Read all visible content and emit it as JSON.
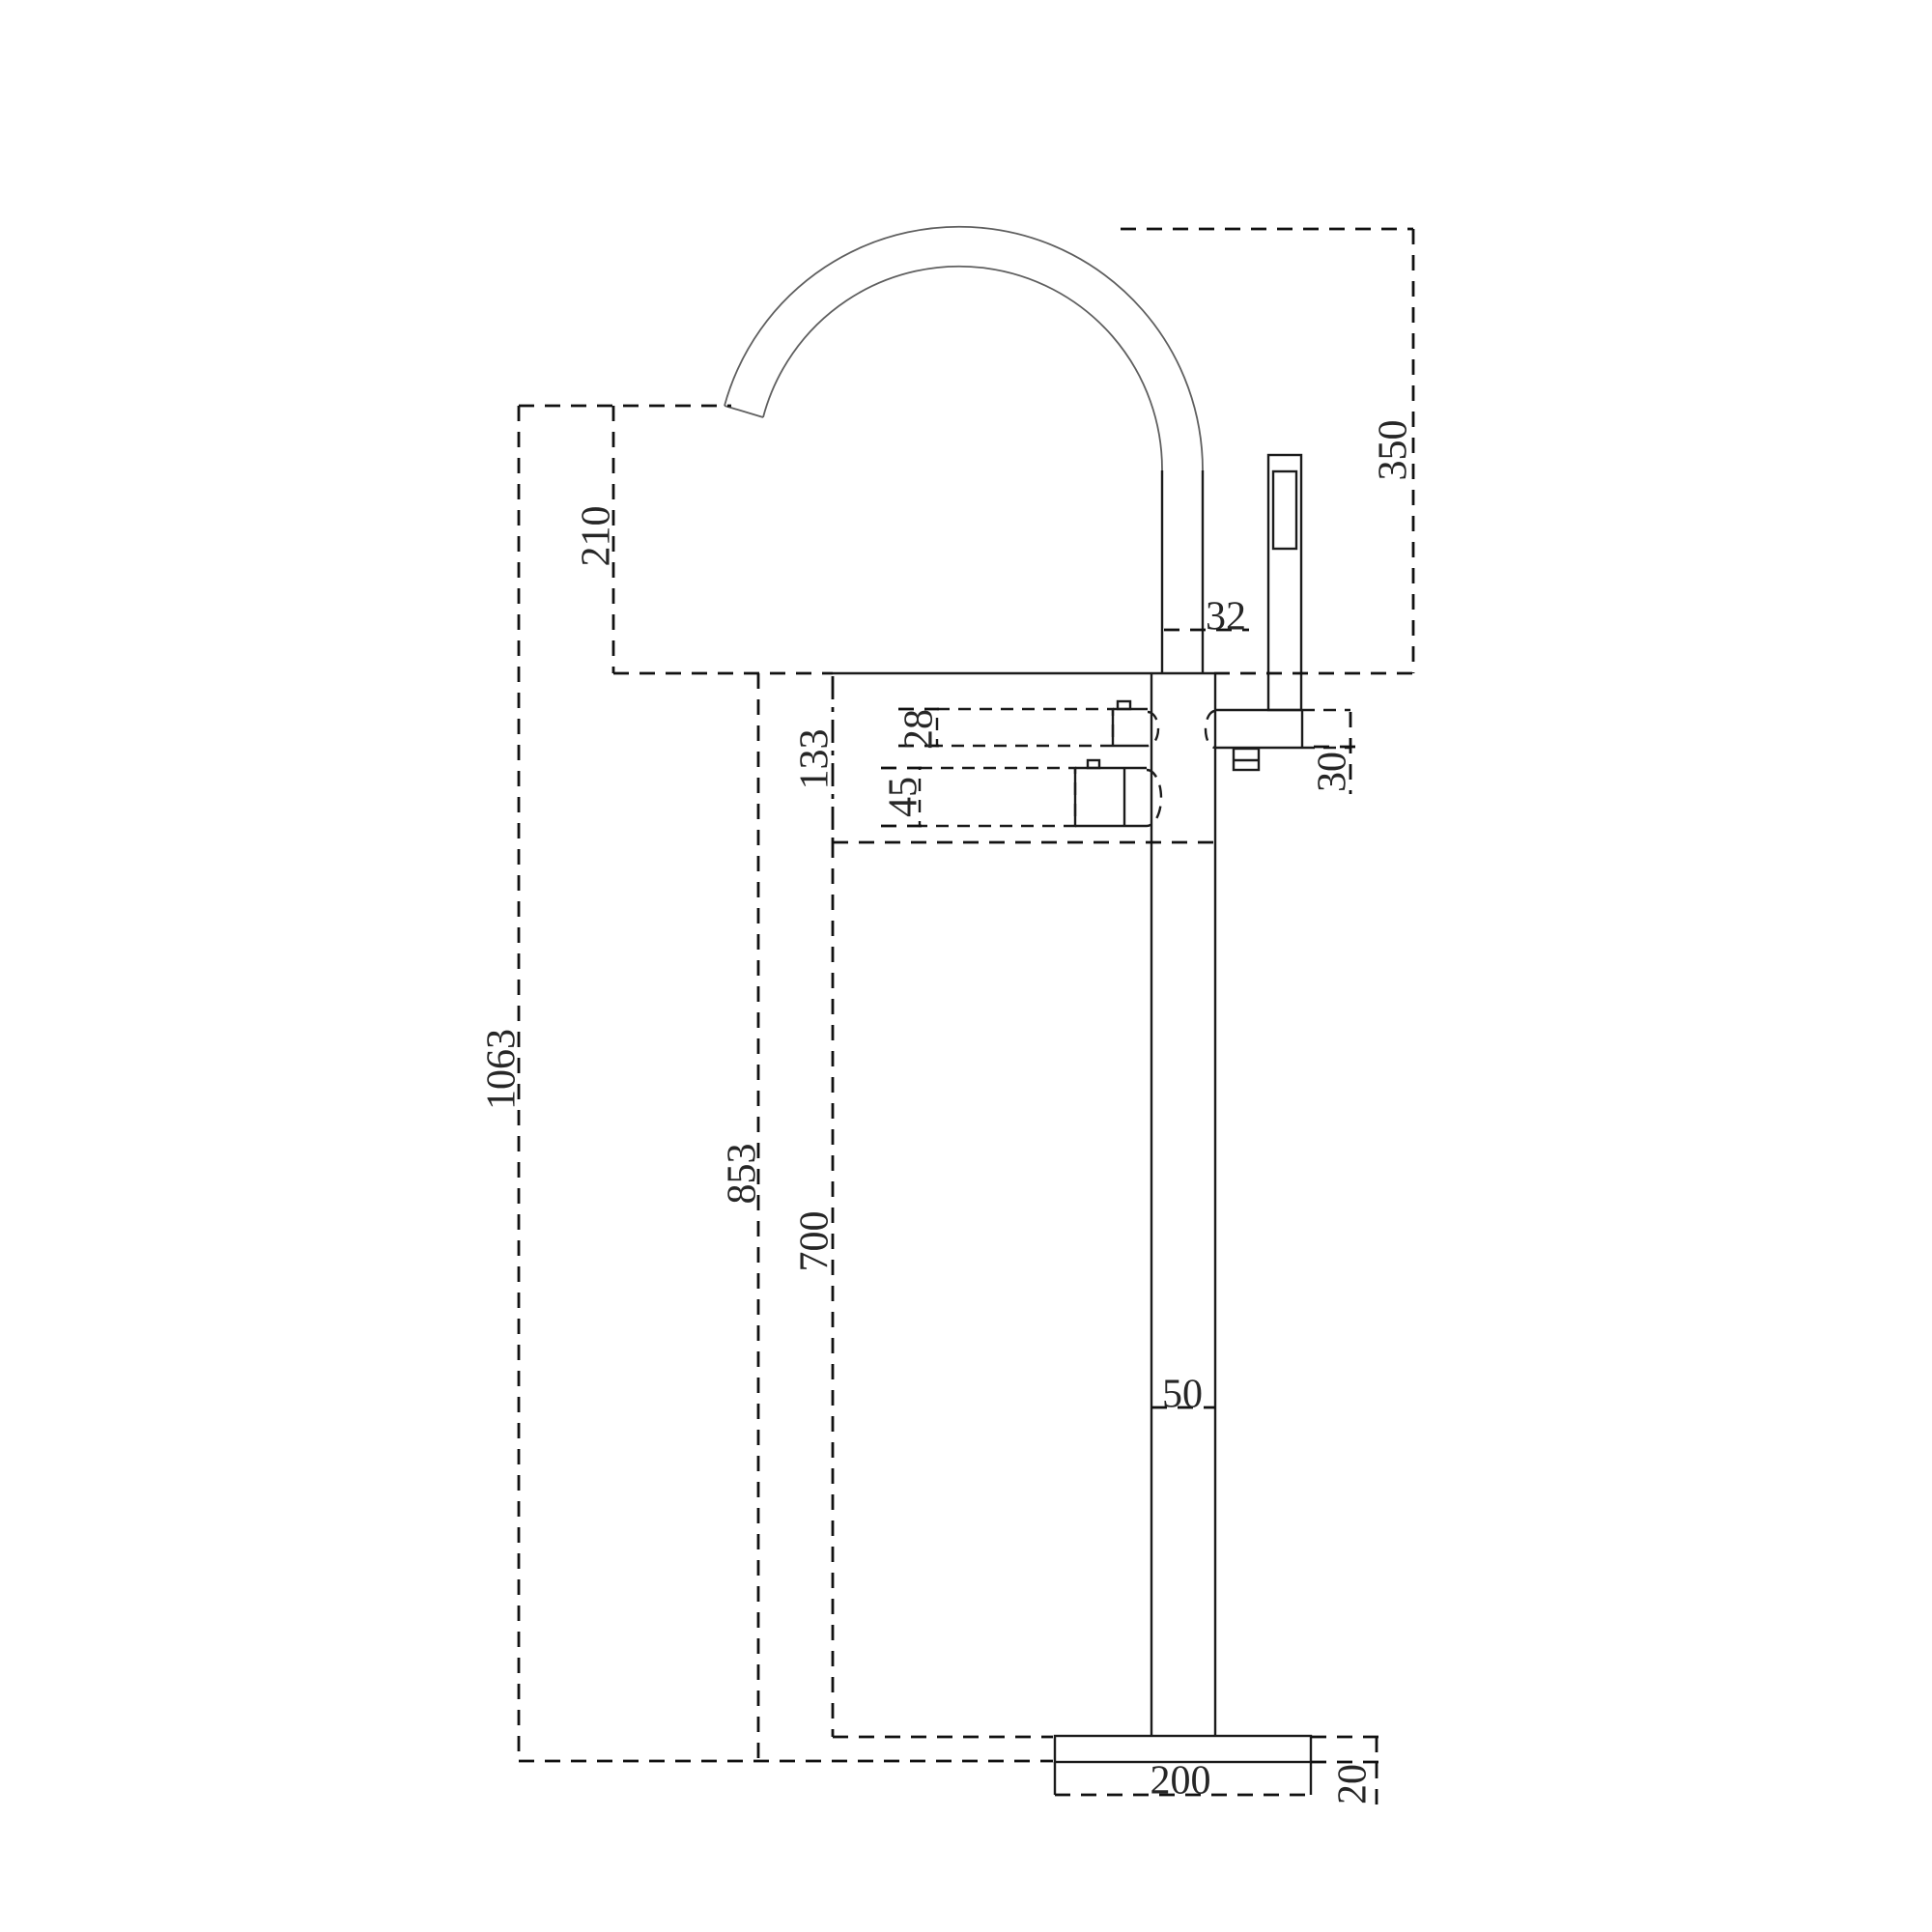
{
  "drawing": {
    "background": "#ffffff",
    "line_color": "#1b1b1b",
    "dimension_line_color": "#111111",
    "spout_arc_color": "#5f5f5f",
    "dims": {
      "spout_outlet_height_above_deck": "210",
      "spout_top_height_above_deck": "350",
      "spout_pipe_diameter": "32",
      "body_section_height": "133",
      "top_handle_height": "28",
      "bottom_handle_height": "45",
      "handshower_holder_height": "30",
      "overall_height_to_outlet": "1063",
      "deck_height_above_floor": "853",
      "column_section_height": "700",
      "column_diameter": "50",
      "base_diameter": "200",
      "base_height": "20"
    }
  }
}
